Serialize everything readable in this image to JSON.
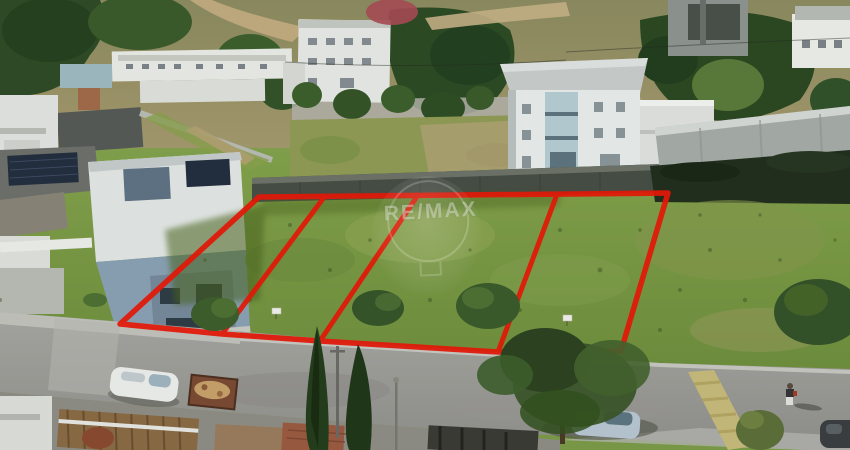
{
  "watermark": {
    "brand": "RE/MAX"
  },
  "scene": {
    "lot_count": 4,
    "colors": {
      "boundary_red": "#e81708",
      "grass_green": "#7a9a48",
      "road_gray": "#9d9c99",
      "stone_wall_gray": "#474d45",
      "concrete_wall_gray": "#a6aba7",
      "house_blue_gray": "#7e95a9",
      "speed_bump_yellow": "#c8b97b",
      "cypress_green": "#243c1c"
    }
  }
}
